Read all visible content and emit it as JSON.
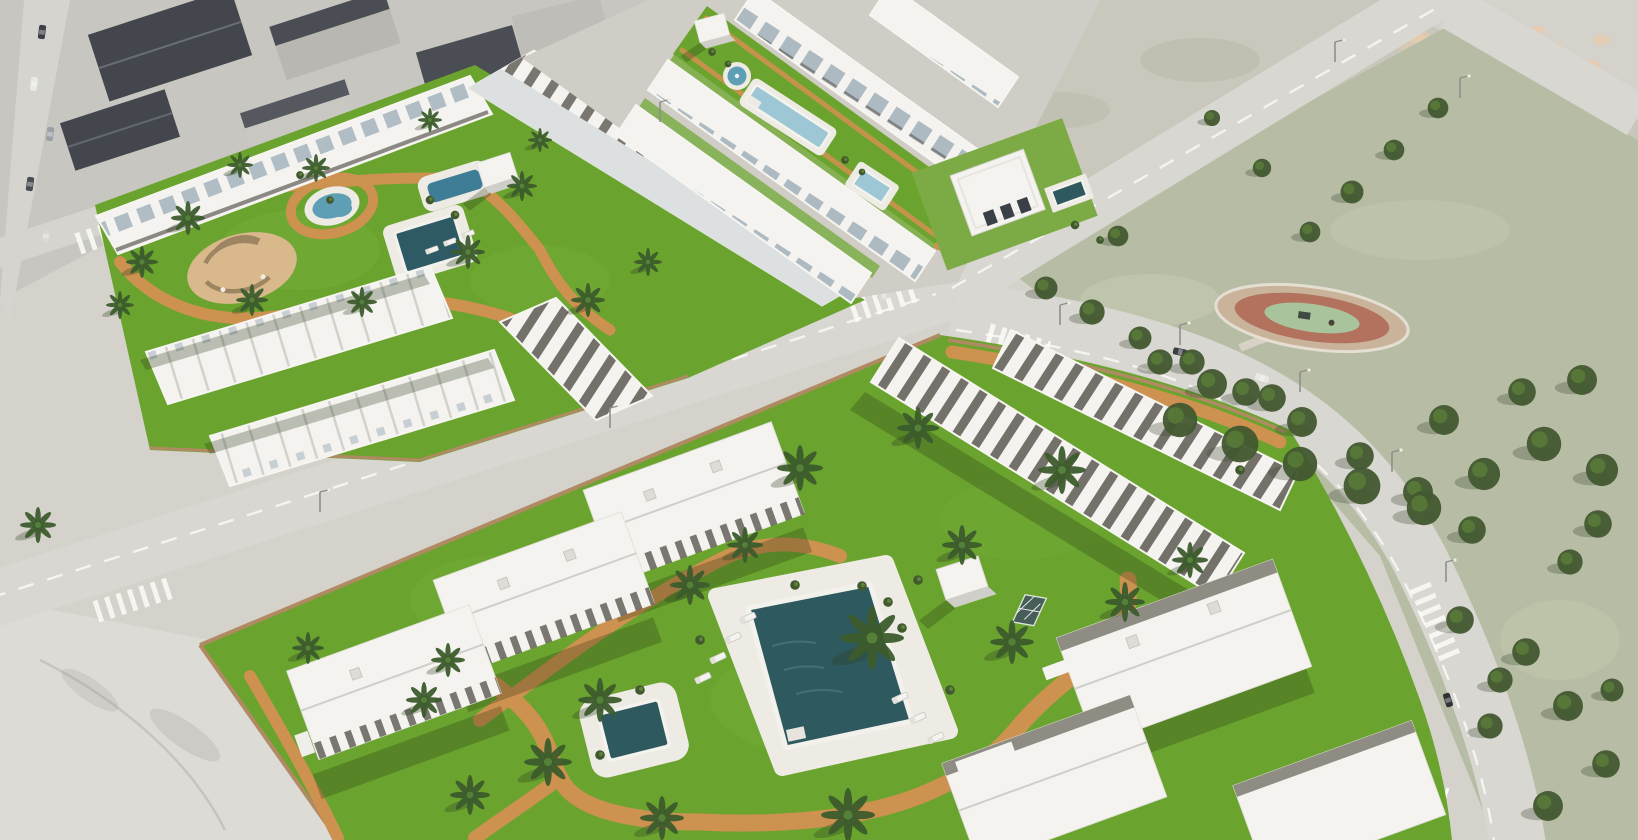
{
  "meta": {
    "description": "Aerial 3D architectural rendering of a new-build Mediterranean residential development: white apartment blocks and gabled townhouse rows arranged around bright green landscaped gardens with palm trees, turquoise and dark-teal swimming pools, a round fountain, terracotta walking paths and sun loungers; the complexes are bordered by light gray streets with zebra crossings, an existing gray-roofed neighborhood in the top left, vacant scrub lots with dirt patches in the top right, and a muted public park with dense pine trees and an oval playground on the right."
  },
  "palette": {
    "ground": "#d4d2cb",
    "pavement": "#dddbd6",
    "cityGround": "#c8c6c0",
    "road": "#d9d7d2",
    "roadLine": "#fbfbf8",
    "grass": "#6aa42e",
    "grassLight": "#85b748",
    "parkGrass": "#b7bda5",
    "scrub": "#c9c7bb",
    "treeDark": "#425930",
    "treeMid": "#5d8438",
    "palmDark": "#3c5c2c",
    "palmMid": "#54803a",
    "path": "#cd9150",
    "patio": "#d9b88c",
    "poolDark": "#2e5a5f",
    "poolLight": "#9ec7d6",
    "pond": "#5f9fb6",
    "building": "#f4f3ef",
    "deck": "#edebe4",
    "roofSlate": "#aab7c0",
    "pergola": "#544f48",
    "wallTan": "#b08a62",
    "dirt": "#e6ccae",
    "glass": "#44565f",
    "shadowColor": "rgba(35,50,18,0.28)"
  },
  "palms": [
    {
      "x": 142,
      "y": 262,
      "s": 0.8
    },
    {
      "x": 188,
      "y": 218,
      "s": 0.85
    },
    {
      "x": 252,
      "y": 300,
      "s": 0.8
    },
    {
      "x": 316,
      "y": 168,
      "s": 0.7
    },
    {
      "x": 362,
      "y": 302,
      "s": 0.75
    },
    {
      "x": 468,
      "y": 252,
      "s": 0.85
    },
    {
      "x": 522,
      "y": 186,
      "s": 0.75
    },
    {
      "x": 588,
      "y": 300,
      "s": 0.85
    },
    {
      "x": 648,
      "y": 262,
      "s": 0.7
    },
    {
      "x": 120,
      "y": 305,
      "s": 0.7
    },
    {
      "x": 240,
      "y": 165,
      "s": 0.65
    },
    {
      "x": 430,
      "y": 120,
      "s": 0.6
    },
    {
      "x": 540,
      "y": 140,
      "s": 0.6
    },
    {
      "x": 38,
      "y": 525,
      "s": 0.9
    },
    {
      "x": 800,
      "y": 468,
      "s": 1.15
    },
    {
      "x": 918,
      "y": 428,
      "s": 1.05
    },
    {
      "x": 1062,
      "y": 470,
      "s": 1.2
    },
    {
      "x": 872,
      "y": 638,
      "s": 1.6
    },
    {
      "x": 962,
      "y": 545,
      "s": 1.0
    },
    {
      "x": 690,
      "y": 585,
      "s": 1.0
    },
    {
      "x": 600,
      "y": 700,
      "s": 1.1
    },
    {
      "x": 548,
      "y": 762,
      "s": 1.2
    },
    {
      "x": 662,
      "y": 818,
      "s": 1.1
    },
    {
      "x": 848,
      "y": 815,
      "s": 1.35
    },
    {
      "x": 1012,
      "y": 642,
      "s": 1.1
    },
    {
      "x": 1125,
      "y": 602,
      "s": 1.0
    },
    {
      "x": 424,
      "y": 700,
      "s": 0.9
    },
    {
      "x": 308,
      "y": 648,
      "s": 0.8
    },
    {
      "x": 745,
      "y": 545,
      "s": 0.9
    },
    {
      "x": 470,
      "y": 795,
      "s": 1.0
    },
    {
      "x": 1190,
      "y": 560,
      "s": 0.9
    },
    {
      "x": 448,
      "y": 660,
      "s": 0.85
    }
  ],
  "parkTrees": [
    {
      "x": 1046,
      "y": 288,
      "s": 1.0
    },
    {
      "x": 1092,
      "y": 312,
      "s": 1.1
    },
    {
      "x": 1140,
      "y": 338,
      "s": 1.0
    },
    {
      "x": 1192,
      "y": 362,
      "s": 1.1
    },
    {
      "x": 1246,
      "y": 392,
      "s": 1.2
    },
    {
      "x": 1302,
      "y": 422,
      "s": 1.3
    },
    {
      "x": 1360,
      "y": 456,
      "s": 1.2
    },
    {
      "x": 1418,
      "y": 492,
      "s": 1.3
    },
    {
      "x": 1472,
      "y": 530,
      "s": 1.2
    },
    {
      "x": 1438,
      "y": 108,
      "s": 0.9
    },
    {
      "x": 1394,
      "y": 150,
      "s": 0.9
    },
    {
      "x": 1352,
      "y": 192,
      "s": 1.0
    },
    {
      "x": 1310,
      "y": 232,
      "s": 0.9
    },
    {
      "x": 1180,
      "y": 420,
      "s": 1.5
    },
    {
      "x": 1240,
      "y": 444,
      "s": 1.6
    },
    {
      "x": 1300,
      "y": 464,
      "s": 1.5
    },
    {
      "x": 1362,
      "y": 486,
      "s": 1.6
    },
    {
      "x": 1424,
      "y": 508,
      "s": 1.5
    },
    {
      "x": 1484,
      "y": 474,
      "s": 1.4
    },
    {
      "x": 1544,
      "y": 444,
      "s": 1.5
    },
    {
      "x": 1602,
      "y": 470,
      "s": 1.4
    },
    {
      "x": 1212,
      "y": 384,
      "s": 1.3
    },
    {
      "x": 1272,
      "y": 398,
      "s": 1.2
    },
    {
      "x": 1444,
      "y": 420,
      "s": 1.3
    },
    {
      "x": 1522,
      "y": 392,
      "s": 1.2
    },
    {
      "x": 1582,
      "y": 380,
      "s": 1.3
    },
    {
      "x": 1160,
      "y": 362,
      "s": 1.1
    },
    {
      "x": 1598,
      "y": 524,
      "s": 1.2
    },
    {
      "x": 1570,
      "y": 562,
      "s": 1.1
    },
    {
      "x": 1526,
      "y": 652,
      "s": 1.2
    },
    {
      "x": 1568,
      "y": 706,
      "s": 1.3
    },
    {
      "x": 1606,
      "y": 764,
      "s": 1.2
    },
    {
      "x": 1490,
      "y": 726,
      "s": 1.1
    },
    {
      "x": 1548,
      "y": 806,
      "s": 1.3
    },
    {
      "x": 1612,
      "y": 690,
      "s": 1.0
    },
    {
      "x": 1460,
      "y": 620,
      "s": 1.2
    },
    {
      "x": 1500,
      "y": 680,
      "s": 1.1
    },
    {
      "x": 1262,
      "y": 168,
      "s": 0.8
    },
    {
      "x": 1212,
      "y": 118,
      "s": 0.7
    },
    {
      "x": 1118,
      "y": 236,
      "s": 0.9
    }
  ],
  "dirtPatches": [
    {
      "x": 1418,
      "y": 38,
      "s": 1.0
    },
    {
      "x": 1452,
      "y": 52,
      "s": 1.2
    },
    {
      "x": 1488,
      "y": 42,
      "s": 0.9
    },
    {
      "x": 1520,
      "y": 60,
      "s": 1.3
    },
    {
      "x": 1556,
      "y": 48,
      "s": 1.0
    },
    {
      "x": 1590,
      "y": 66,
      "s": 1.2
    },
    {
      "x": 1470,
      "y": 82,
      "s": 1.1
    },
    {
      "x": 1504,
      "y": 94,
      "s": 0.9
    },
    {
      "x": 1540,
      "y": 86,
      "s": 1.2
    },
    {
      "x": 1574,
      "y": 100,
      "s": 1.0
    },
    {
      "x": 1608,
      "y": 88,
      "s": 0.9
    },
    {
      "x": 1434,
      "y": 70,
      "s": 0.8
    },
    {
      "x": 1602,
      "y": 40,
      "s": 1.0
    },
    {
      "x": 1586,
      "y": 112,
      "s": 0.8
    },
    {
      "x": 1466,
      "y": 28,
      "s": 0.9
    },
    {
      "x": 1538,
      "y": 30,
      "s": 0.8
    }
  ],
  "cars": [
    {
      "x": 42,
      "y": 32,
      "r": 97,
      "c": "#3c4046"
    },
    {
      "x": 34,
      "y": 84,
      "r": 97,
      "c": "#e9e9e6"
    },
    {
      "x": 50,
      "y": 134,
      "r": 98,
      "c": "#9aa0a6"
    },
    {
      "x": 30,
      "y": 184,
      "r": 98,
      "c": "#494c52"
    },
    {
      "x": 46,
      "y": 236,
      "r": 100,
      "c": "#d8d8d4"
    },
    {
      "x": 762,
      "y": 16,
      "r": 10,
      "c": "#44474c"
    },
    {
      "x": 818,
      "y": 26,
      "r": 10,
      "c": "#eceae6"
    },
    {
      "x": 1180,
      "y": 352,
      "r": 12,
      "c": "#3a3d41"
    },
    {
      "x": 1262,
      "y": 378,
      "r": 18,
      "c": "#e8e8e5"
    },
    {
      "x": 1448,
      "y": 700,
      "r": 72,
      "c": "#2f3236"
    },
    {
      "x": 884,
      "y": 296,
      "r": -17,
      "c": "#d9d9d5"
    }
  ],
  "loungers": [
    {
      "x": 748,
      "y": 618,
      "r": -25
    },
    {
      "x": 733,
      "y": 638,
      "r": -25
    },
    {
      "x": 718,
      "y": 658,
      "r": -25
    },
    {
      "x": 703,
      "y": 678,
      "r": -25
    },
    {
      "x": 900,
      "y": 698,
      "r": -25
    },
    {
      "x": 918,
      "y": 718,
      "r": -25
    },
    {
      "x": 936,
      "y": 738,
      "r": -25
    },
    {
      "x": 432,
      "y": 250,
      "r": -20,
      "s": 0.8
    },
    {
      "x": 450,
      "y": 242,
      "r": -20,
      "s": 0.8
    },
    {
      "x": 468,
      "y": 234,
      "r": -20,
      "s": 0.8
    }
  ],
  "poles": [
    {
      "x": 1060,
      "y": 325
    },
    {
      "x": 1180,
      "y": 345
    },
    {
      "x": 1300,
      "y": 392
    },
    {
      "x": 1392,
      "y": 472
    },
    {
      "x": 1446,
      "y": 582
    },
    {
      "x": 320,
      "y": 512
    },
    {
      "x": 610,
      "y": 428
    },
    {
      "x": 660,
      "y": 122
    },
    {
      "x": 1335,
      "y": 62
    },
    {
      "x": 1460,
      "y": 98
    }
  ],
  "bushes": [
    {
      "x": 862,
      "y": 586,
      "s": 1
    },
    {
      "x": 888,
      "y": 602,
      "s": 1
    },
    {
      "x": 902,
      "y": 628,
      "s": 1
    },
    {
      "x": 795,
      "y": 585,
      "s": 1
    },
    {
      "x": 640,
      "y": 690,
      "s": 1
    },
    {
      "x": 600,
      "y": 755,
      "s": 1
    },
    {
      "x": 330,
      "y": 200,
      "s": 0.8
    },
    {
      "x": 300,
      "y": 175,
      "s": 0.8
    },
    {
      "x": 430,
      "y": 200,
      "s": 0.9
    },
    {
      "x": 455,
      "y": 215,
      "s": 0.9
    },
    {
      "x": 1075,
      "y": 225,
      "s": 0.9
    },
    {
      "x": 1100,
      "y": 240,
      "s": 0.8
    },
    {
      "x": 918,
      "y": 580,
      "s": 1
    },
    {
      "x": 1240,
      "y": 470,
      "s": 1
    },
    {
      "x": 950,
      "y": 690,
      "s": 1
    },
    {
      "x": 700,
      "y": 640,
      "s": 1
    },
    {
      "x": 712,
      "y": 52,
      "s": 0.8
    },
    {
      "x": 728,
      "y": 64,
      "s": 0.7
    },
    {
      "x": 845,
      "y": 160,
      "s": 0.8
    },
    {
      "x": 862,
      "y": 172,
      "s": 0.7
    }
  ]
}
